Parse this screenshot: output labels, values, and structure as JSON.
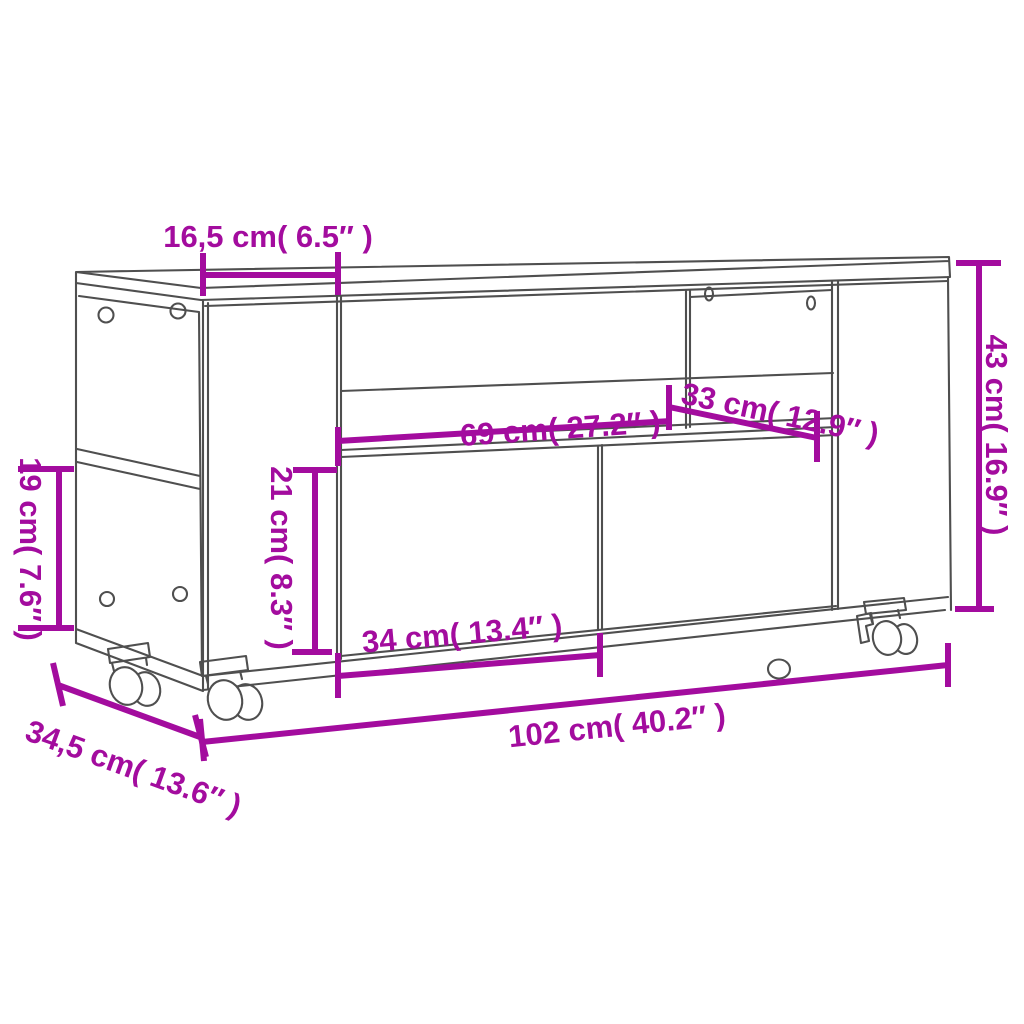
{
  "colors": {
    "dimension": "#a30c9e",
    "outline": "#4f4f4f",
    "background": "#ffffff"
  },
  "dimensions": {
    "left_section_width": {
      "label": "16,5 cm( 6.5″ )",
      "cm": "16,5",
      "inches": "6.5"
    },
    "overall_height": {
      "label": "43 cm( 16.9″ )",
      "cm": "43",
      "inches": "16.9"
    },
    "right_compartment_width": {
      "label": "33 cm( 12.9″ )",
      "cm": "33",
      "inches": "12.9"
    },
    "middle_shelf_width": {
      "label": "69 cm( 27.2″ )",
      "cm": "69",
      "inches": "27.2"
    },
    "door_height": {
      "label": "21 cm( 8.3″ )",
      "cm": "21",
      "inches": "8.3"
    },
    "side_compartment_height": {
      "label": "19 cm( 7.6″ )",
      "cm": "19",
      "inches": "7.6"
    },
    "door_width": {
      "label": "34 cm( 13.4″ )",
      "cm": "34",
      "inches": "13.4"
    },
    "overall_width": {
      "label": "102 cm( 40.2″ )",
      "cm": "102",
      "inches": "40.2"
    },
    "overall_depth": {
      "label": "34,5 cm( 13.6″ )",
      "cm": "34,5",
      "inches": "13.6"
    }
  }
}
